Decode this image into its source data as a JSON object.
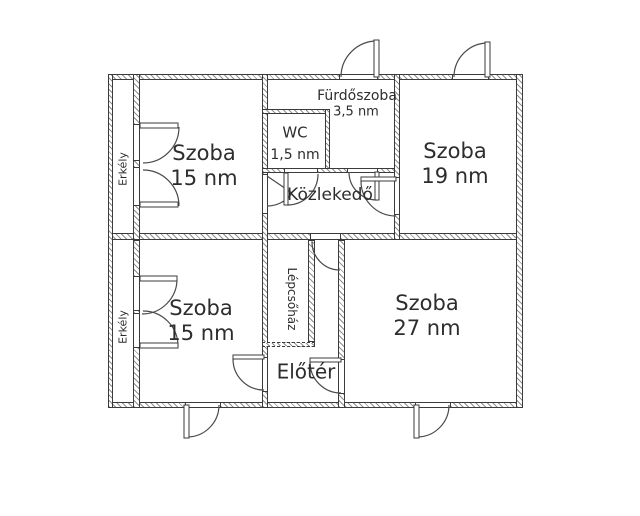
{
  "plan_title": "Apartment floor plan",
  "colors": {
    "wall_line": "#3b3b3b",
    "hatch": "#8f8f8f",
    "text": "#2d2d2d",
    "background": "#ffffff",
    "swing_line": "#4a4a4a"
  },
  "rooms": {
    "szoba_top_left": {
      "name": "Szoba",
      "area": "15 nm"
    },
    "szoba_top_right": {
      "name": "Szoba",
      "area": "19 nm"
    },
    "szoba_bottom_left": {
      "name": "Szoba",
      "area": "15 nm"
    },
    "szoba_bottom_right": {
      "name": "Szoba",
      "area": "27 nm"
    },
    "wc": {
      "name": "WC",
      "area": "1,5 nm"
    },
    "furdoszoba": {
      "name": "Fürdőszoba",
      "area": "3,5 nm"
    },
    "kozlekedo": {
      "name": "Közlekedő"
    },
    "eloter": {
      "name": "Előtér"
    },
    "lepcsohaz": {
      "name": "Lépcsőház"
    },
    "erkely_top": {
      "name": "Erkély"
    },
    "erkely_bottom": {
      "name": "Erkély"
    }
  }
}
